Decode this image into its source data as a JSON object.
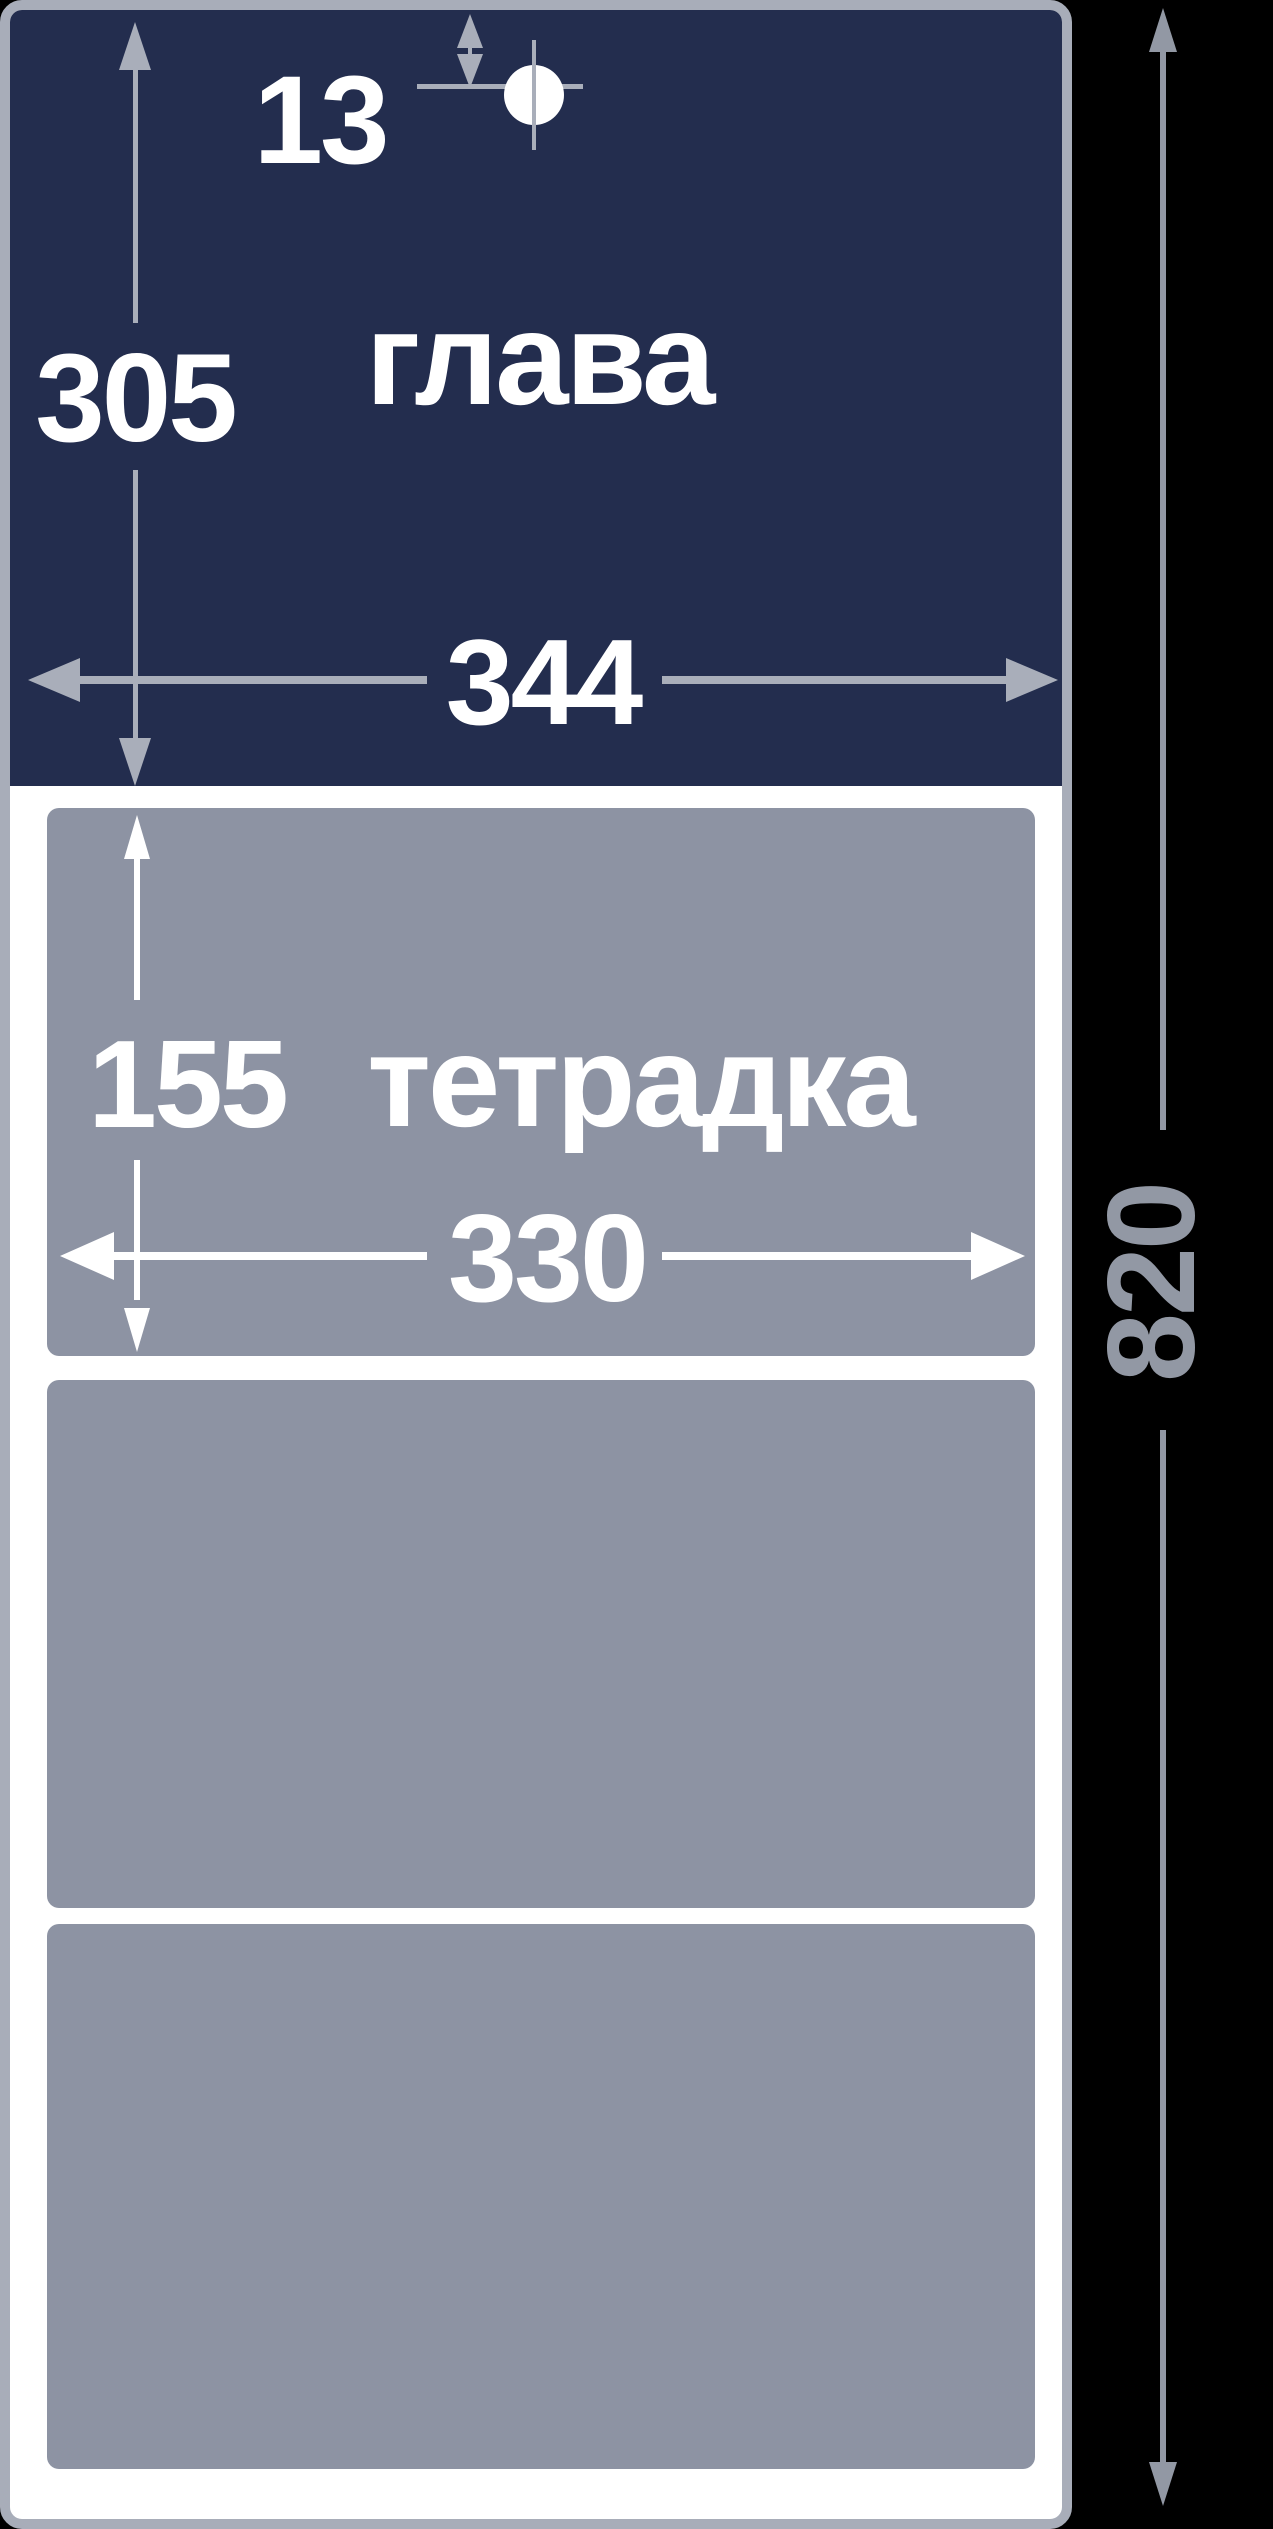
{
  "figure": {
    "background_color": "#000000",
    "page": {
      "fill": "#ffffff",
      "border_color": "#a8adb9"
    },
    "header_block": {
      "label": "глава",
      "fill": "#232d4e",
      "text_color": "#ffffff",
      "dims": {
        "height": "305",
        "width": "344",
        "hole_offset": "13"
      },
      "hole_marker": "crosshair-hole"
    },
    "notebook_block": {
      "label": "тетрадка",
      "fill": "#8d93a3",
      "text_color": "#ffffff",
      "panel_count": 3,
      "dims": {
        "height": "155",
        "width": "330"
      }
    },
    "overall": {
      "height": "820",
      "dim_color": "#9298a4"
    },
    "dim_line_color_header": "#a9aeba",
    "dim_line_color_panel": "#ffffff"
  }
}
